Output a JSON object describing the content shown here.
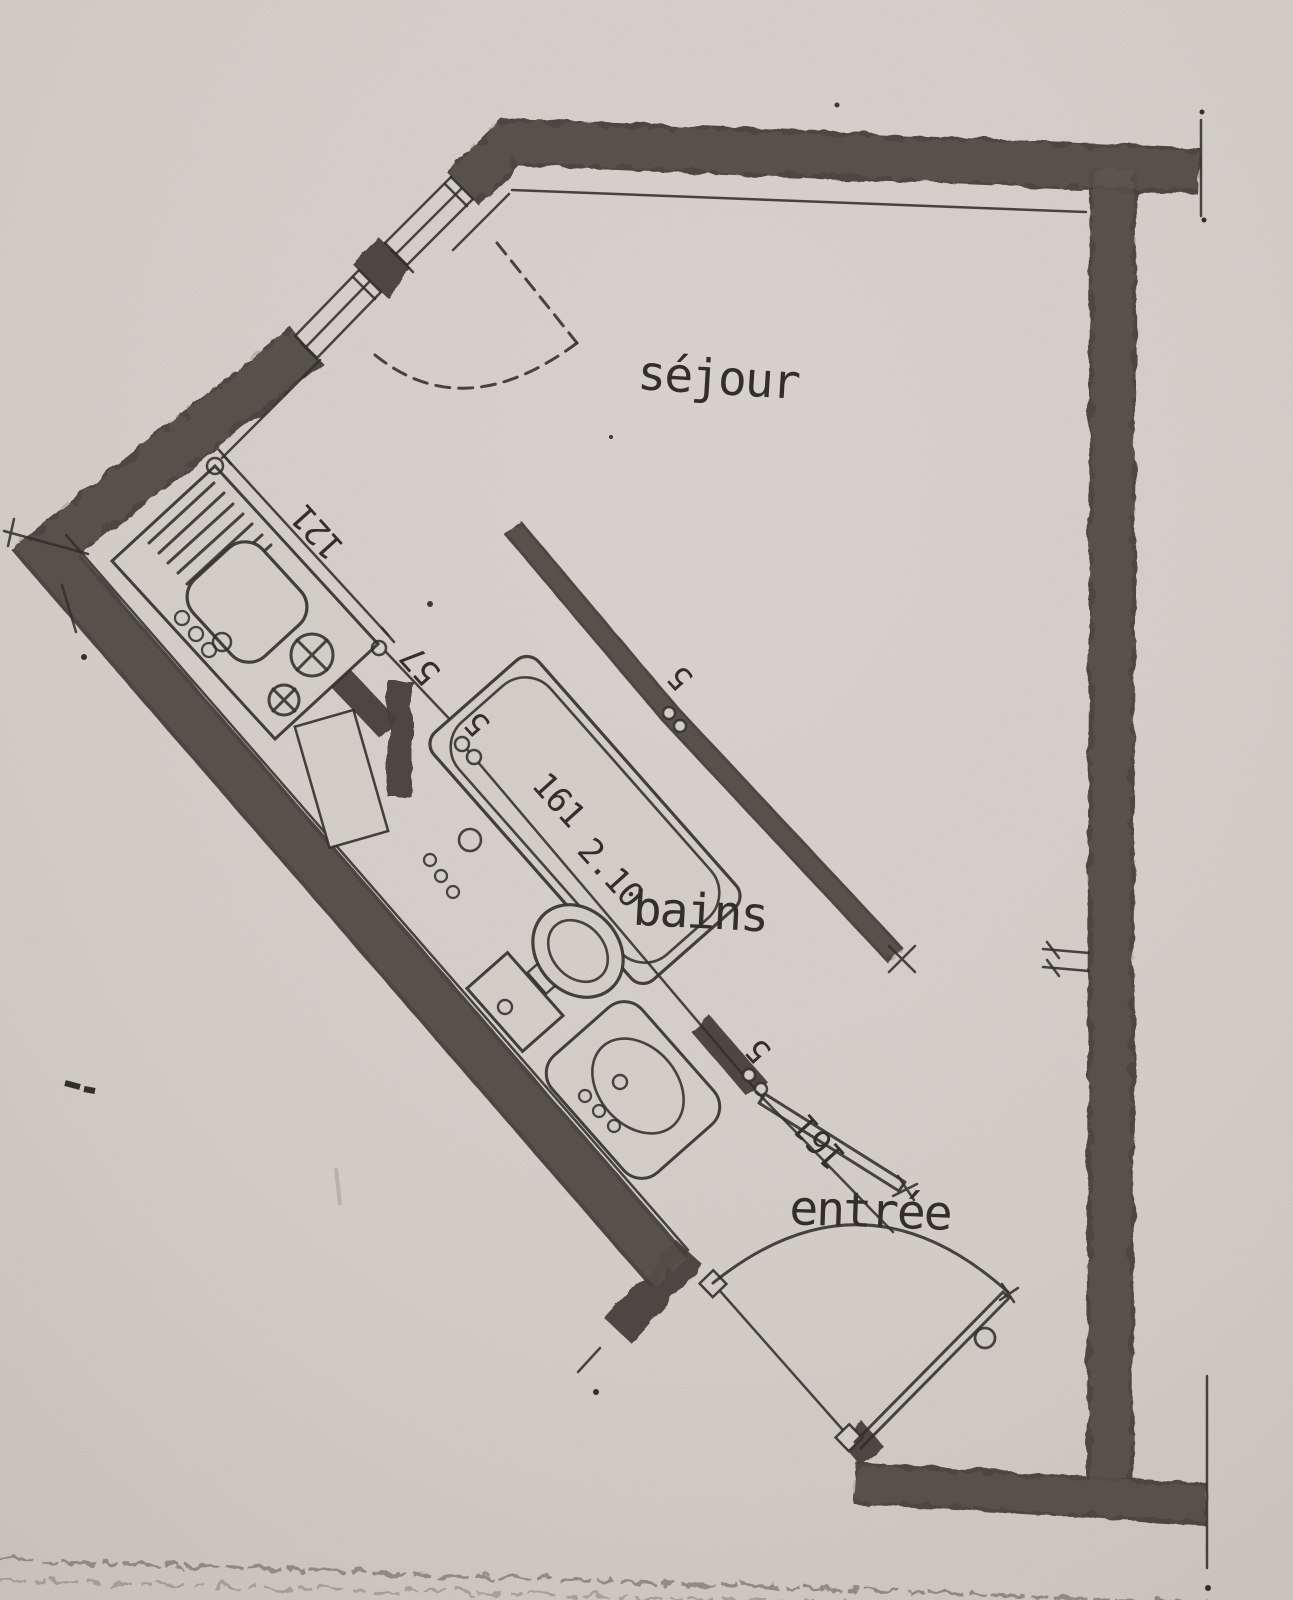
{
  "plan": {
    "type": "architectural floor plan (scanned)",
    "language": "French",
    "rooms": {
      "sejour": "séjour",
      "bains": "bains",
      "entree": "entrée"
    },
    "dimensions": {
      "counter_length": "121",
      "passage_width": "57",
      "partition_thickness": "5",
      "bath_wall_thickness": "5",
      "bathtub_length": "161",
      "bathroom_width": "2.10",
      "door_wall_thickness": "5",
      "entry_door_width": "161"
    },
    "fixtures": {
      "kitchen": [
        "draining-board",
        "sink",
        "hob-burners"
      ],
      "bathroom": [
        "bathtub",
        "toilet",
        "washbasin"
      ],
      "doors": [
        "sejour-door-dashed-swing",
        "bathroom-door",
        "entry-door"
      ],
      "windows": [
        "upper-diagonal-window",
        "lower-diagonal-window"
      ]
    },
    "colors": {
      "paper": "#d6d2ca",
      "ink": "#2e2b27",
      "wall": "#403b34"
    }
  }
}
